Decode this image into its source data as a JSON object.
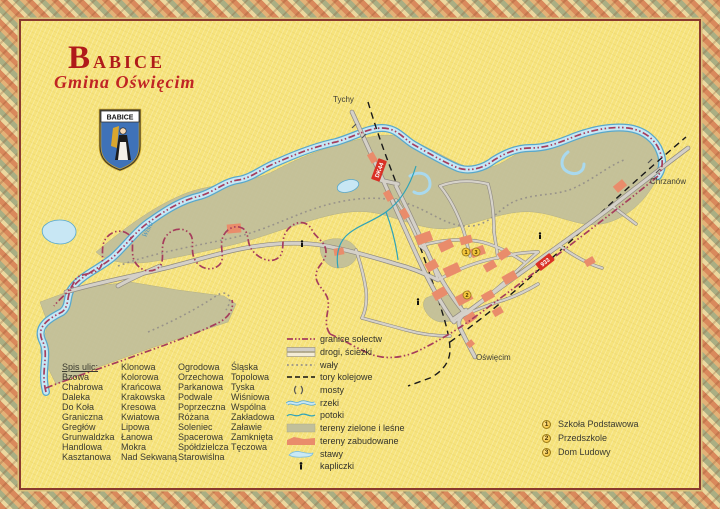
{
  "palette": {
    "background": "#f6e37c",
    "frame_line": "#8a3a2e",
    "title_red": "#b01a1a",
    "boundary": "#a63d5c",
    "river_blue": "#58a8cc",
    "green_area": "#c1bf9b",
    "built_area": "#e98c6b",
    "road_marker_red": "#d93025",
    "poi_gold": "#f4c63c"
  },
  "header": {
    "title": "Babice",
    "subtitle": "Gmina Oświęcim"
  },
  "crest": {
    "banner": "BABICE"
  },
  "map": {
    "labels": {
      "tychy": "Tychy",
      "chrzanow": "Chrzanów",
      "oswiecim": "Oświęcim",
      "river": "Wisła"
    },
    "road_markers": {
      "dk44": "DK44",
      "r933": "933"
    },
    "poi": {
      "school": "1",
      "dom_ludowy": "3",
      "przedszkole": "2"
    }
  },
  "legend": {
    "items": [
      "granice sołectw",
      "drogi, ścieżki",
      "wały",
      "tory kolejowe",
      "mosty",
      "rzeki",
      "potoki",
      "tereny zielone i leśne",
      "tereny zabudowane",
      "stawy",
      "kapliczki"
    ]
  },
  "streets": {
    "heading": "Spis ulic:",
    "col1": [
      "Bzowa",
      "Chabrowa",
      "Daleka",
      "Do Koła",
      "Graniczna",
      "Gregłów",
      "Grunwaldzka",
      "Handlowa",
      "Kasztanowa"
    ],
    "col2": [
      "Klonowa",
      "Kolorowa",
      "Krańcowa",
      "Krakowska",
      "Kresowa",
      "Kwiatowa",
      "Lipowa",
      "Łanowa",
      "Mokra",
      "Nad Sekwaną"
    ],
    "col3": [
      "Ogrodowa",
      "Orzechowa",
      "Parkanowa",
      "Podwale",
      "Poprzeczna",
      "Różana",
      "Soleniec",
      "Spacerowa",
      "Spółdzielcza",
      "Starowiślna"
    ],
    "col4": [
      "Śląska",
      "Topolowa",
      "Tyska",
      "Wiśniowa",
      "Wspólna",
      "Zakładowa",
      "Załawie",
      "Zamknięta",
      "Tęczowa"
    ]
  },
  "poi_legend": {
    "items": [
      {
        "num": "1",
        "label": "Szkoła Podstawowa"
      },
      {
        "num": "2",
        "label": "Przedszkole"
      },
      {
        "num": "3",
        "label": "Dom Ludowy"
      }
    ]
  }
}
